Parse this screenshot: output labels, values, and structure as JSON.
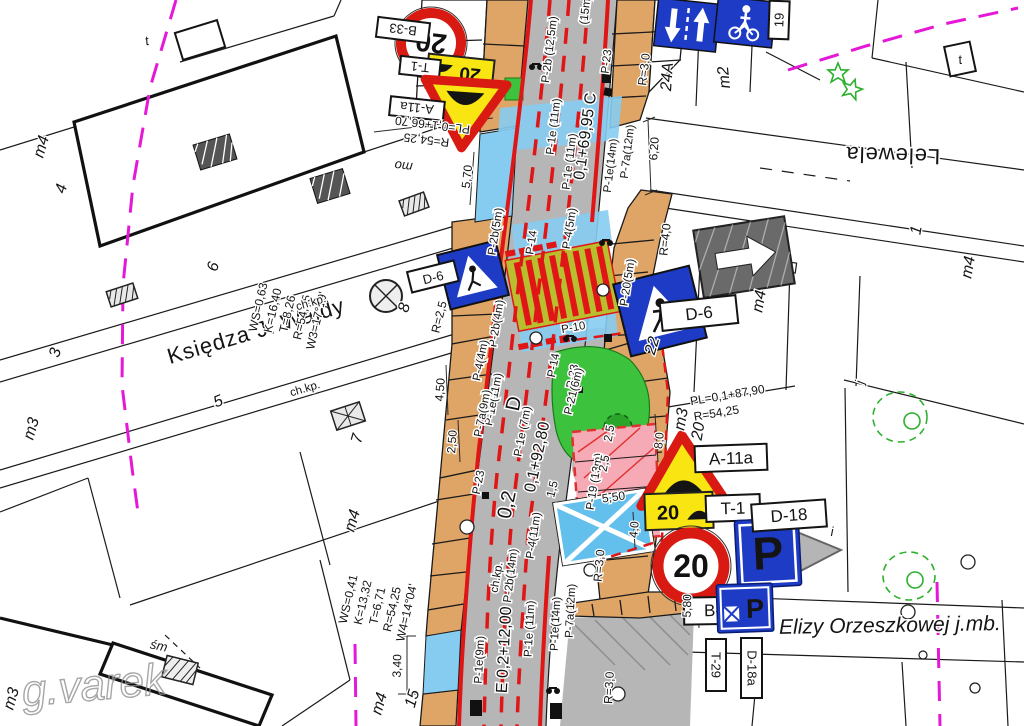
{
  "streets": {
    "wajdy": "Księdza J. Wajdy",
    "lelewela": "Lelewela",
    "orzeszkowej": "Elizy Orzeszkowej  j.mb."
  },
  "watermark": "g.varek",
  "sign_labels": {
    "b33": "B-33",
    "t1": "T-1",
    "a11a": "A-11a",
    "d6": "D-6",
    "d18": "D-18",
    "d18a": "D-18a",
    "t29": "T-29"
  },
  "sign_values": {
    "speed20": "20"
  },
  "geometry": {
    "w3": [
      "W3=17°19'",
      "R=54,25",
      "T=8,26",
      "K=16,40",
      "WS=0,63"
    ],
    "w4": [
      "W4=14°04'",
      "R=54,25",
      "T=6,71",
      "K=13,32",
      "WS=0,41"
    ],
    "pl_top": "PL=0,1+66,70",
    "r_top": "R=54,25",
    "pl_mid": "PL=0,1+87,90",
    "r_mid": "R=54,25"
  },
  "chainage": {
    "c": "0,1+69,95 C",
    "d": "0,1+92,80",
    "d_next": "0,2",
    "sec_d": "D",
    "e": "E 0,2+12,00"
  },
  "markings": {
    "p2b125": "P-2b (12,5m)",
    "m15": "(15m)",
    "p1e11": "P-1e (11m)",
    "p1e11b": "P-1e(11m)",
    "p1e14": "P-1e(14m)",
    "p7a12": "P-7a(12m)",
    "p23": "P-23",
    "p2b5": "P-2b(5m)",
    "p2b4": "P-2b(4m)",
    "p14": "P-14",
    "p45": "P-4(5m)",
    "p205": "P-20(5m)",
    "p10": "P-10",
    "p44": "P-4(4m)",
    "p7a9": "P-7a(9m)",
    "p1e7": "P-1e (7m)",
    "p216": "P-21(6m)",
    "p1913": "P-19 (13m)",
    "p411": "P-4(11m)",
    "p2b14": "P-2b(14m)",
    "p1e9": "P-1e(9m)"
  },
  "dimensions": {
    "d620": "6,20",
    "d570": "5,70",
    "r40": "R=4,0",
    "r30": "R=3,0",
    "r25": "R=2,5",
    "d450": "4,50",
    "d250": "2,50",
    "d25": "2,5",
    "d550": "5,50",
    "d15": "1,5",
    "d80": "8,0",
    "d40": "4,0",
    "d340": "3,40",
    "d580": "5,80"
  },
  "parcels": {
    "n1": "1",
    "n3": "3",
    "n4": "4",
    "n5": "5",
    "n6": "6",
    "n7": "7",
    "n8": "8",
    "n15": "15",
    "n19": "19",
    "n20": "20",
    "n22": "22",
    "n24a": "24A",
    "m2": "m2",
    "m3": "m3",
    "m4": "m4",
    "i": "i",
    "j": "j",
    "t": "t",
    "sm": "śm",
    "chkp": "ch.kp.",
    "mo": "mo"
  }
}
